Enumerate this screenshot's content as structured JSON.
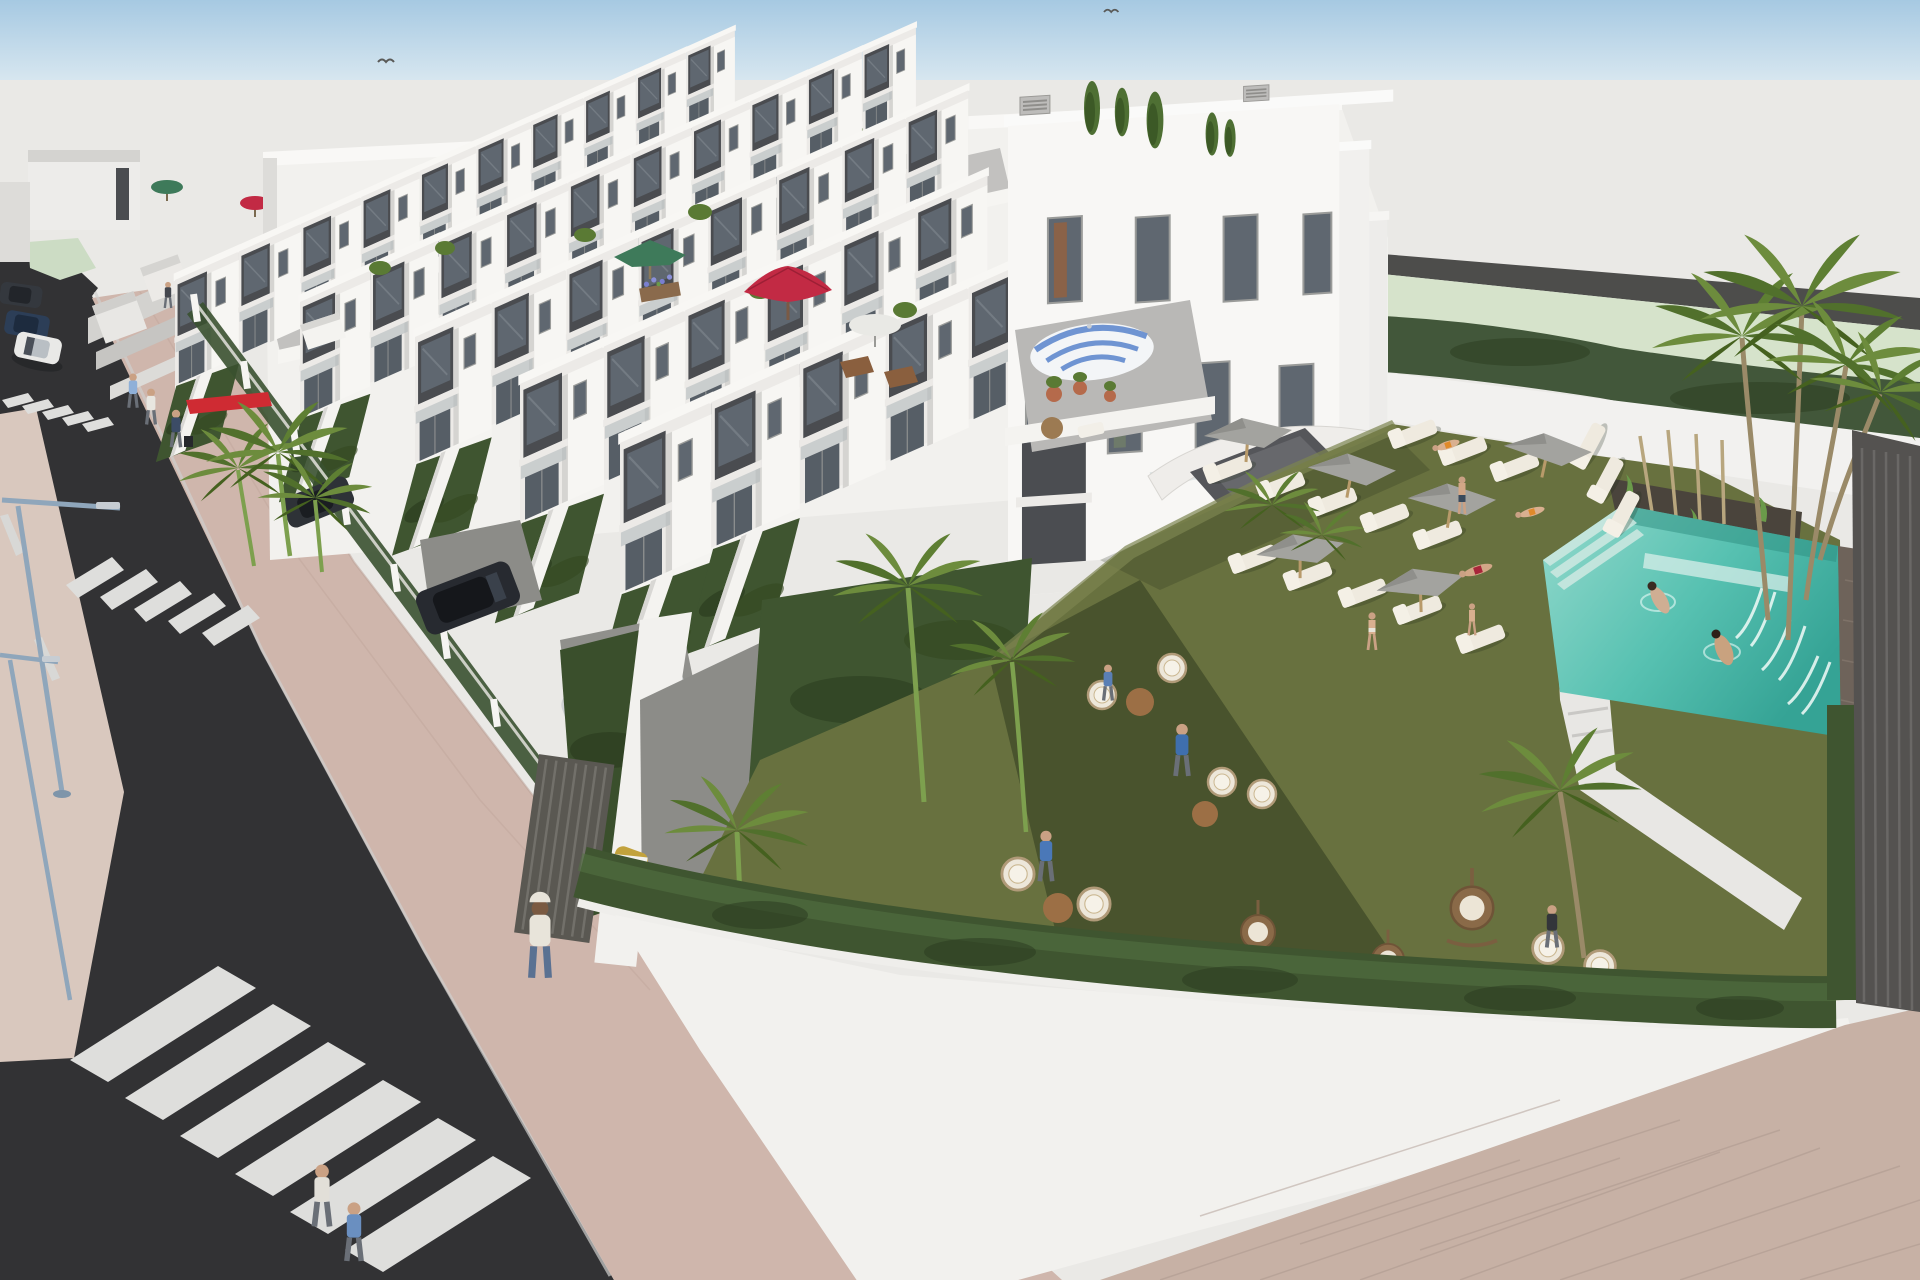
{
  "meta": {
    "description": "Aerial 3D architectural rendering of a modern white terraced townhouse development with rooftop terraces, a communal lawn garden, swimming pool with waterfall, sun loungers with parasols, hedged street-front gardens, and an asphalt street with zebra crossings.",
    "render_type": "exterior-visualization",
    "time_of_day": "midday-sun"
  },
  "palette": {
    "sky_top": "#a6c9e2",
    "sky_horizon": "#d8e7f0",
    "backdrop": "#eae9e6",
    "field": "#d6e3cb",
    "road_strip": "#4d4d4b",
    "white_sun": "#f7f6f3",
    "white_mid": "#eceae7",
    "white_shade": "#d2d1ce",
    "panel_dark": "#4a4c50",
    "glass": "#5f6770",
    "lawn": "#68713f",
    "hedge": "#3f5530",
    "hedge_dark": "#2c3d20",
    "pool_light": "#93d9cc",
    "pool_mid": "#57c1b1",
    "pool_deep": "#35a395",
    "stone": "#6e635a",
    "asphalt": "#323234",
    "stripe": "#dededc",
    "sidewalk": "#cfb6ac",
    "median": "#d9c8be",
    "walkway": "#f2f1ee",
    "brick": "#c7b1a5",
    "fence_dark": "#545250",
    "umbrella_grey": "#a3a39f",
    "umbrella_red": "#c22a44",
    "umbrella_green": "#3e7a5a",
    "umbrella_tan": "#d9c9a2",
    "umbrella_white": "#e9e9e5",
    "umbrella_stripe_blue": "#6f94d2",
    "terracotta": "#b56a4b",
    "palm_green": "#6d8c3d",
    "palm_dark": "#51702c",
    "trunk": "#a4946f",
    "car_white": "#e9e9e7",
    "car_navy": "#2c3e57",
    "car_dark": "#34383e",
    "car_suv": "#272a30",
    "car_silver": "#cfd2d4",
    "car_yellow": "#c2a23c",
    "accent_red": "#cf2b33",
    "pole_blue": "#8fa6bb",
    "skin": "#d2a787"
  },
  "scene": {
    "sky": {
      "band_height_px": 80,
      "birds": 2
    },
    "background": {
      "green_field_right": true,
      "dark_road_strip_right": true
    },
    "buildings": {
      "style": "white cubic townhouses, dark grey recessed panels, glass balconies",
      "rows": 5,
      "floors": 3,
      "back_block_slit_windows": 13,
      "end_building_windows": 8,
      "ac_units": 4,
      "roof_umbrellas": [
        "green",
        "red",
        "green",
        "crimson",
        "white",
        "tan",
        "blue-white-striped"
      ],
      "roof_plants": true
    },
    "street": {
      "crosswalks": 3,
      "streetlights": 2,
      "lane_dashes": 2,
      "parked_cars": [
        "dark-grey",
        "navy",
        "white"
      ],
      "driveway_cars": [
        "dark-roof-car",
        "black-suv",
        "silver-hatchback",
        "yellow-hatchback"
      ],
      "pedestrians": 8,
      "red_awning_on_hedge": true,
      "fence_posts": 9
    },
    "garden": {
      "lawn": true,
      "hedge_border": true,
      "palm_trees": 9,
      "wicker_chairs": 9,
      "hanging_egg_chairs": 3,
      "side_tables": 5,
      "people": 7,
      "entrance_canopy": true,
      "steps": true
    },
    "pool_area": {
      "sun_loungers": 16,
      "grey_parasols": 6,
      "sunbathers": 5,
      "pool": {
        "swimmers": 2,
        "waterfall": true,
        "corner_steps": true,
        "stone_wall": true,
        "palm_cluster": true
      }
    }
  }
}
